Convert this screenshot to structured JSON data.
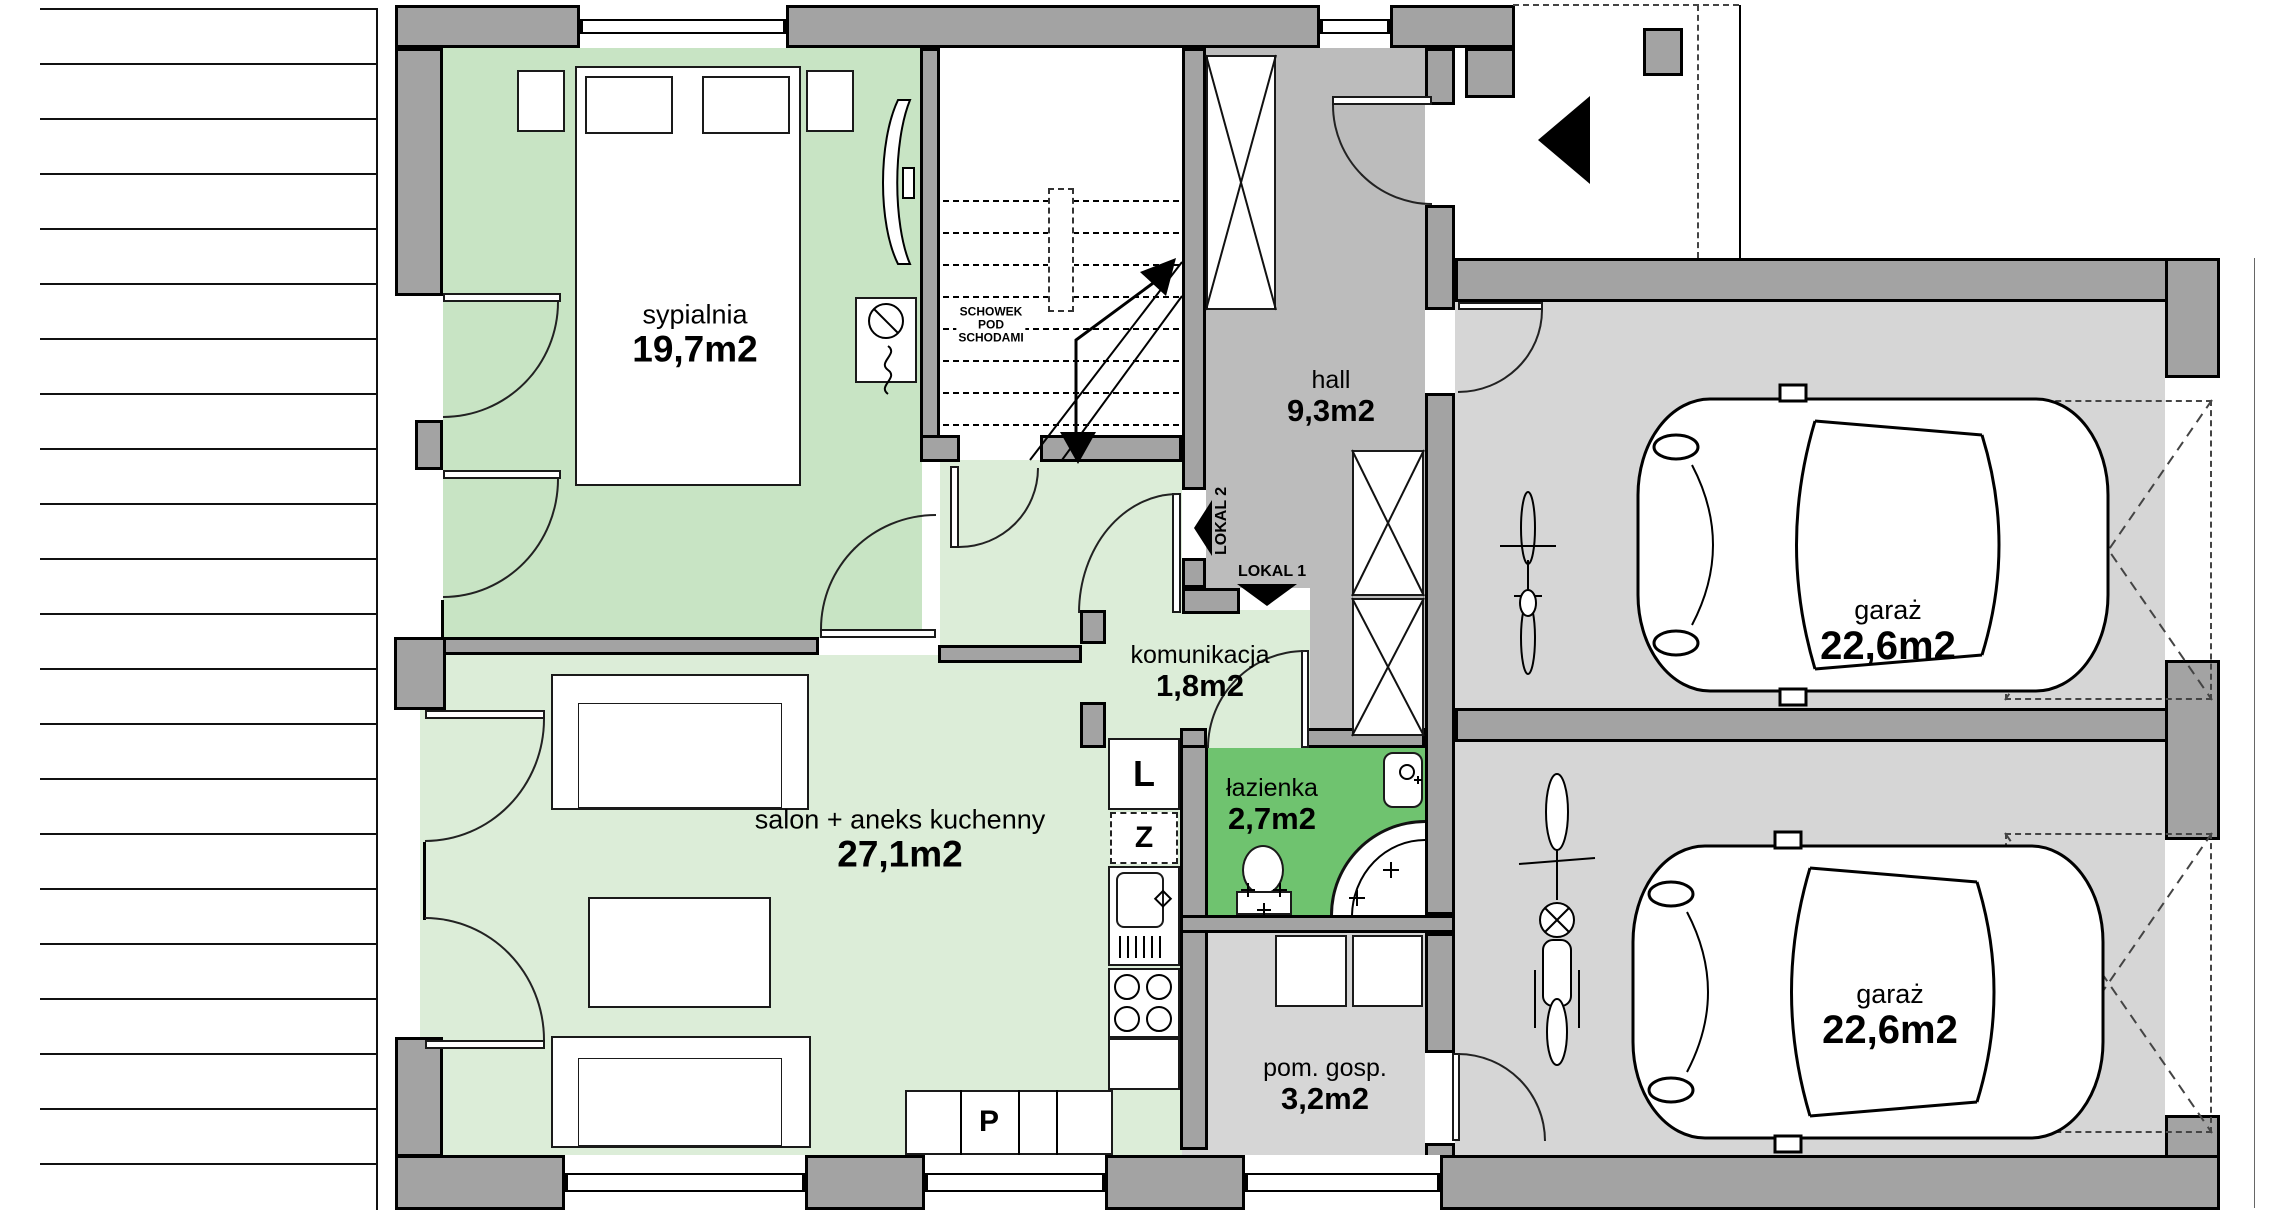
{
  "rooms": {
    "bedroom": {
      "name": "sypialnia",
      "area": "19,7m2"
    },
    "hall": {
      "name": "hall",
      "area": "9,3m2"
    },
    "communication": {
      "name": "komunikacja",
      "area": "1,8m2"
    },
    "bathroom": {
      "name": "łazienka",
      "area": "2,7m2"
    },
    "living_room": {
      "name": "salon + aneks kuchenny",
      "area": "27,1m2"
    },
    "utility": {
      "name": "pom. gosp.",
      "area": "3,2m2"
    },
    "garage_top": {
      "name": "garaż",
      "area": "22,6m2"
    },
    "garage_bottom": {
      "name": "garaż",
      "area": "22,6m2"
    }
  },
  "annotations": {
    "under_stairs_line1": "SCHOWEK",
    "under_stairs_line2": "POD",
    "under_stairs_line3": "SCHODAMI",
    "unit1": "LOKAL 1",
    "unit2": "LOKAL 2"
  },
  "kitchen": {
    "fridge": "L",
    "dishwasher": "Z",
    "oven": "P"
  },
  "colors": {
    "pale_green": "#dcedd8",
    "bedroom_green": "#c8e4c4",
    "bathroom_green": "#6fc36f",
    "hall_gray": "#bcbcbc",
    "garage_gray": "#d6d6d6",
    "wall_gray": "#a3a3a3",
    "line_black": "#000000"
  }
}
